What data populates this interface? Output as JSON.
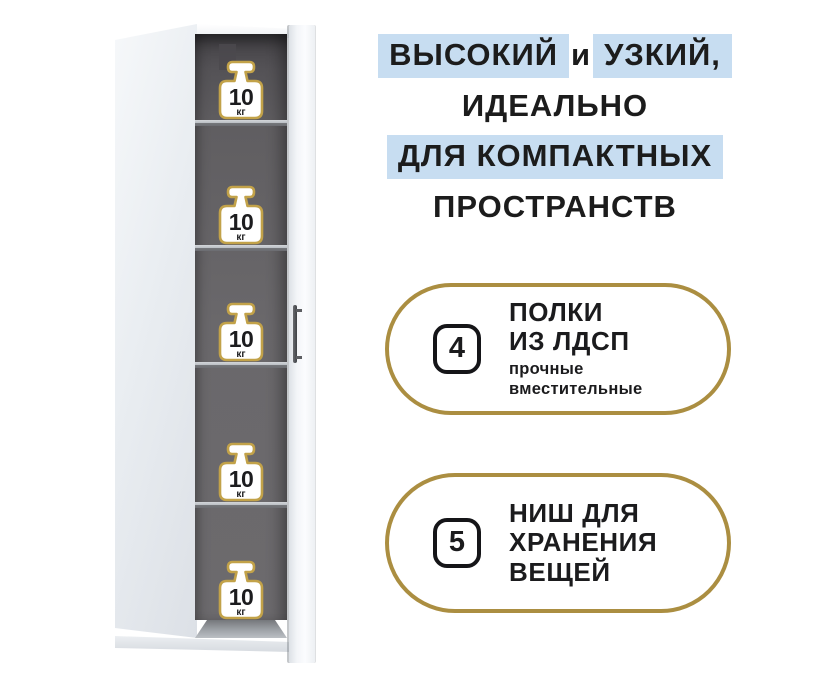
{
  "page": {
    "background": "#ffffff"
  },
  "headline": {
    "line1_highlight1": "ВЫСОКИЙ",
    "line1_plain": "и",
    "line1_highlight2": "УЗКИЙ,",
    "line2": "ИДЕАЛЬНО",
    "line3_highlight": "ДЛЯ КОМПАКТНЫХ",
    "line4": "ПРОСТРАНСТВ",
    "highlight_color": "#c7ddf1"
  },
  "features": [
    {
      "number": "4",
      "title_lines": [
        "ПОЛКИ",
        "ИЗ ЛДСП"
      ],
      "subtitle_lines": [
        "прочные",
        "вместительные"
      ]
    },
    {
      "number": "5",
      "title_lines": [
        "НИШ ДЛЯ",
        "ХРАНЕНИЯ",
        "ВЕЩЕЙ"
      ],
      "subtitle_lines": []
    }
  ],
  "cabinet": {
    "niche_count": 5,
    "shelf_count": 4,
    "weight_value": "10",
    "weight_unit": "кг"
  },
  "colors": {
    "gold_outline": "#ab8e41",
    "icon_gold": "#c2a249",
    "highlight_blue": "#c7ddf1",
    "text_dark": "#1b1b1d",
    "interior_gray": "#6a686b"
  }
}
